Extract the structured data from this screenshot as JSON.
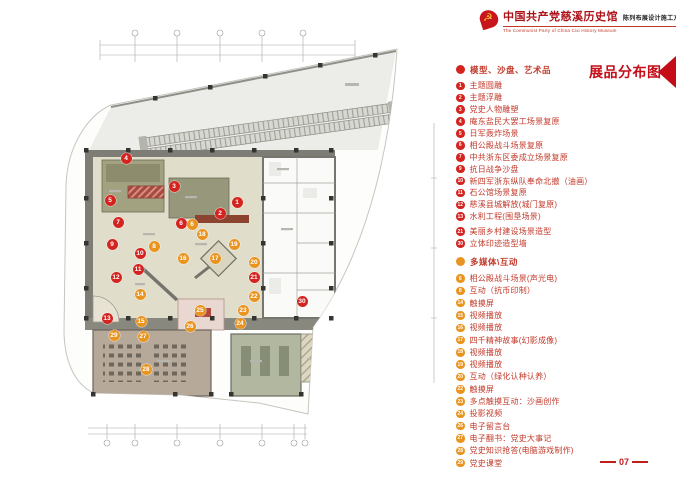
{
  "header": {
    "title_cn": "中国共产党慈溪历史馆",
    "subtitle_cn": "陈列布展设计施工方案",
    "title_en": "The Communist Party of China Cixi  History Museum",
    "emblem_glyph": "☭"
  },
  "page_title": "展品分布图",
  "page_number": "07",
  "legend": {
    "sections": [
      {
        "key": "models",
        "label": "模型、沙盘、艺术品",
        "color": "#d42420",
        "items": [
          {
            "n": "1",
            "label": "主题圆雕"
          },
          {
            "n": "2",
            "label": "主题浮雕"
          },
          {
            "n": "3",
            "label": "党史人物雕塑"
          },
          {
            "n": "4",
            "label": "庵东盐民大罢工场景复原"
          },
          {
            "n": "5",
            "label": "日军轰炸场景"
          },
          {
            "n": "6",
            "label": "相公殿战斗场景复原"
          },
          {
            "n": "7",
            "label": "中共浙东区委成立场景复原"
          },
          {
            "n": "9",
            "label": "抗日战争沙盘"
          },
          {
            "n": "10",
            "label": "新四军浙东纵队奉命北撤（油画）"
          },
          {
            "n": "11",
            "label": "石公馆场景复原"
          },
          {
            "n": "12",
            "label": "慈溪县城解放(城门复原)"
          },
          {
            "n": "13",
            "label": "水利工程(围垦场景)"
          },
          {
            "n": "21",
            "label": "美丽乡村建设场景造型",
            "g": 1
          },
          {
            "n": "30",
            "label": "立体印迹造型墙"
          }
        ]
      },
      {
        "key": "multimedia",
        "label": "多媒体\\互动",
        "color": "#ea9420",
        "items": [
          {
            "n": "6",
            "label": "相公殿战斗场景(声光电)"
          },
          {
            "n": "8",
            "label": "互动（抗币印制）"
          },
          {
            "n": "14",
            "label": "触摸屏"
          },
          {
            "n": "15",
            "label": "视频播放"
          },
          {
            "n": "16",
            "label": "视频播放"
          },
          {
            "n": "17",
            "label": "四千精神故事(幻影成像)"
          },
          {
            "n": "18",
            "label": "视频播放"
          },
          {
            "n": "19",
            "label": "视频播放"
          },
          {
            "n": "20",
            "label": "互动（绿化认种认养）"
          },
          {
            "n": "22",
            "label": "触摸屏"
          },
          {
            "n": "23",
            "label": "多点触摸互动：沙画创作"
          },
          {
            "n": "24",
            "label": "投影视频"
          },
          {
            "n": "26",
            "label": "电子留言台"
          },
          {
            "n": "27",
            "label": "电子翻书：党史大事记"
          },
          {
            "n": "28",
            "label": "党史知识抢答(电脑游戏制作)"
          },
          {
            "n": "29",
            "label": "党史课堂"
          }
        ]
      }
    ]
  },
  "floorplan": {
    "colors": {
      "model": "#d42420",
      "media": "#ea9420"
    },
    "markers": [
      {
        "n": "1",
        "type": "model",
        "x": 192,
        "y": 174
      },
      {
        "n": "2",
        "type": "model",
        "x": 175,
        "y": 185
      },
      {
        "n": "3",
        "type": "model",
        "x": 129,
        "y": 158
      },
      {
        "n": "4",
        "type": "model",
        "x": 81,
        "y": 130
      },
      {
        "n": "5",
        "type": "model",
        "x": 65,
        "y": 172
      },
      {
        "n": "6",
        "type": "model",
        "x": 136,
        "y": 195
      },
      {
        "n": "7",
        "type": "model",
        "x": 73,
        "y": 194
      },
      {
        "n": "9",
        "type": "model",
        "x": 67,
        "y": 216
      },
      {
        "n": "10",
        "type": "model",
        "x": 95,
        "y": 225
      },
      {
        "n": "11",
        "type": "model",
        "x": 93,
        "y": 241
      },
      {
        "n": "12",
        "type": "model",
        "x": 71,
        "y": 249
      },
      {
        "n": "13",
        "type": "model",
        "x": 62,
        "y": 290
      },
      {
        "n": "21",
        "type": "model",
        "x": 209,
        "y": 249
      },
      {
        "n": "30",
        "type": "model",
        "x": 257,
        "y": 273
      },
      {
        "n": "6",
        "type": "media",
        "x": 147,
        "y": 196
      },
      {
        "n": "8",
        "type": "media",
        "x": 109,
        "y": 218
      },
      {
        "n": "14",
        "type": "media",
        "x": 95,
        "y": 266
      },
      {
        "n": "15",
        "type": "media",
        "x": 96,
        "y": 293
      },
      {
        "n": "16",
        "type": "media",
        "x": 138,
        "y": 230
      },
      {
        "n": "17",
        "type": "media",
        "x": 170,
        "y": 230
      },
      {
        "n": "18",
        "type": "media",
        "x": 157,
        "y": 206
      },
      {
        "n": "19",
        "type": "media",
        "x": 189,
        "y": 216
      },
      {
        "n": "20",
        "type": "media",
        "x": 209,
        "y": 234
      },
      {
        "n": "22",
        "type": "media",
        "x": 209,
        "y": 268
      },
      {
        "n": "23",
        "type": "media",
        "x": 198,
        "y": 282
      },
      {
        "n": "24",
        "type": "media",
        "x": 195,
        "y": 295
      },
      {
        "n": "25",
        "type": "media",
        "x": 155,
        "y": 282
      },
      {
        "n": "26",
        "type": "media",
        "x": 145,
        "y": 298
      },
      {
        "n": "27",
        "type": "media",
        "x": 98,
        "y": 308
      },
      {
        "n": "28",
        "type": "media",
        "x": 101,
        "y": 341
      },
      {
        "n": "29",
        "type": "media",
        "x": 69,
        "y": 307
      }
    ]
  }
}
